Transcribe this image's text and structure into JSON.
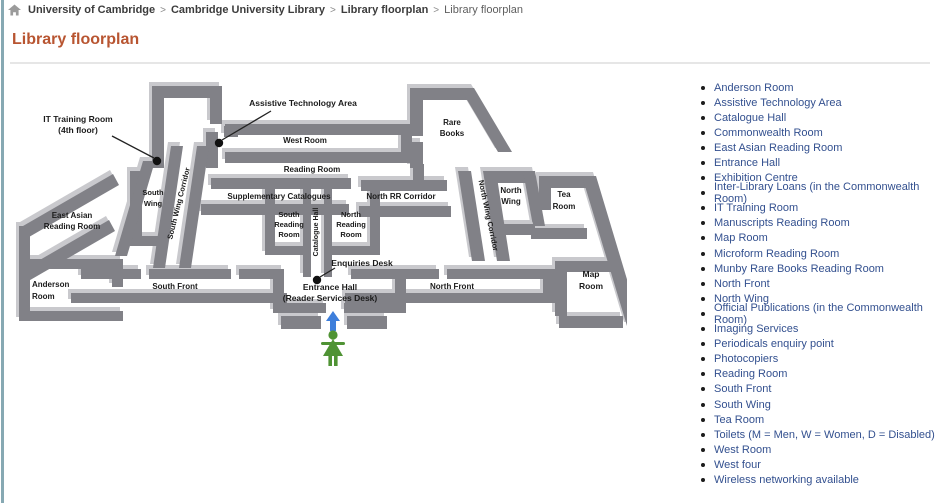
{
  "breadcrumb": {
    "separator": ">",
    "items": [
      "University of Cambridge",
      "Cambridge University Library",
      "Library floorplan",
      "Library floorplan"
    ]
  },
  "title": "Library floorplan",
  "colors": {
    "title": "#b85531",
    "sidebar_link": "#33508f",
    "wall_dark": "#818187",
    "wall_light": "#c9c9cd",
    "person_green": "#4f9334",
    "arrow_blue": "#3d7edb",
    "left_edge": "#87a9b3"
  },
  "floorplan": {
    "labels": {
      "it_training": [
        "IT Training Room",
        "(4th floor)"
      ],
      "assistive": "Assistive Technology Area",
      "west_room": "West Room",
      "reading_room": "Reading Room",
      "supplementary_catalogues": "Supplementary Catalogues",
      "north_rr_corridor": "North RR Corridor",
      "rare_books": [
        "Rare",
        "Books"
      ],
      "south_wing": [
        "South",
        "Wing"
      ],
      "south_wing_corridor": "South Wing Corridor",
      "east_asian": [
        "East Asian",
        "Reading Room"
      ],
      "catalogue_hall": "Catalogue Hall",
      "south_reading": [
        "South",
        "Reading",
        "Room"
      ],
      "north_reading": [
        "North",
        "Reading",
        "Room"
      ],
      "north_wing_corridor": "North Wing Corridor",
      "north_wing": [
        "North",
        "Wing"
      ],
      "tea_room": [
        "Tea",
        "Room"
      ],
      "enquiries_desk": "Enquiries Desk",
      "anderson": [
        "Anderson",
        "Room"
      ],
      "south_front": "South Front",
      "entrance_hall": [
        "Entrance Hall",
        "(Reader Services Desk)"
      ],
      "north_front": "North Front",
      "map_room": [
        "Map",
        "Room"
      ]
    }
  },
  "sidebar": {
    "links": [
      "Anderson Room",
      "Assistive Technology Area",
      "Catalogue Hall",
      "Commonwealth Room",
      "East Asian Reading Room",
      "Entrance Hall",
      "Exhibition Centre",
      "Inter-Library Loans (in the Commonwealth Room)",
      "IT Training Room",
      "Manuscripts Reading Room",
      "Map Room",
      "Microform Reading Room",
      "Munby Rare Books Reading Room",
      "North Front",
      "North Wing",
      "Official Publications (in the Commonwealth Room)",
      "Imaging Services",
      "Periodicals enquiry point",
      "Photocopiers",
      "Reading Room",
      "South Front",
      "South Wing",
      "Tea Room",
      "Toilets (M = Men, W = Women, D = Disabled)",
      "West Room",
      "West four",
      "Wireless networking available"
    ]
  }
}
